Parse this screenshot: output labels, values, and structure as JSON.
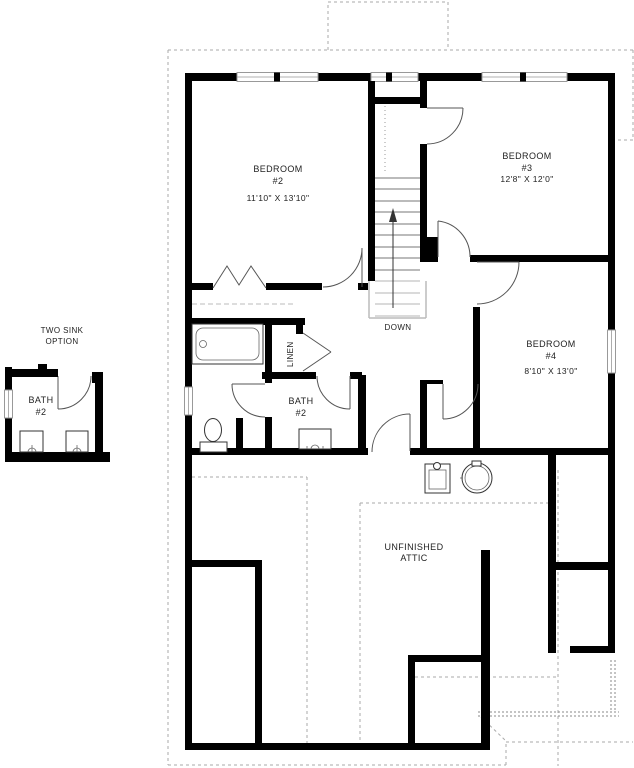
{
  "rooms": {
    "bedroom2": {
      "name": "BEDROOM",
      "number": "#2",
      "dims": "11'10\" X 13'10\""
    },
    "bedroom3": {
      "name": "BEDROOM",
      "number": "#3",
      "dims": "12'8\" X 12'0\""
    },
    "bedroom4": {
      "name": "BEDROOM",
      "number": "#4",
      "dims": "8'10\" X 13'0\""
    },
    "bath2": {
      "name": "BATH",
      "number": "#2"
    },
    "bath2_option": {
      "name": "BATH",
      "number": "#2"
    },
    "linen": {
      "name": "LINEN"
    },
    "attic": {
      "line1": "UNFINISHED",
      "line2": "ATTIC"
    }
  },
  "annotations": {
    "stair_direction": "DOWN",
    "option_line1": "TWO SINK",
    "option_line2": "OPTION"
  },
  "colors": {
    "wall": "#000000",
    "fixture_line": "#333333",
    "dashed_line": "#aaaaaa",
    "text": "#222222",
    "background": "#ffffff"
  }
}
